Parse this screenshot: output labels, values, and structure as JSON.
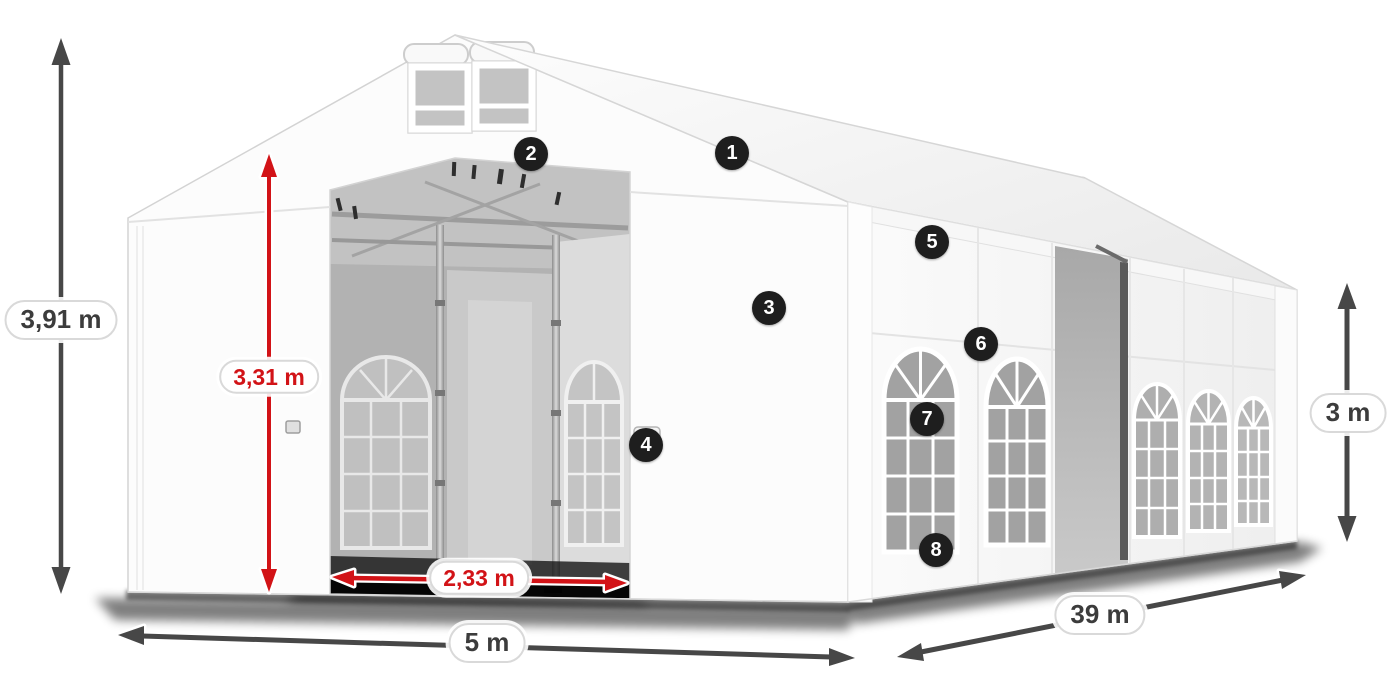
{
  "page": {
    "background_color": "#ffffff"
  },
  "product_diagram": {
    "subject": "white marquee party tent 3d render with dimension annotations",
    "colors": {
      "arrow_dark": "#474747",
      "arrow_red": "#d21317",
      "label_text_dark": "#3c3c3c",
      "label_text_red": "#d21317",
      "label_background": "#ffffff",
      "label_border": "#d9d9d9",
      "badge_background": "#1e1e1e",
      "badge_text": "#ffffff",
      "tent_white": "#fbfbfb",
      "interior_gray": "#b2b2b2"
    },
    "dimension_labels": [
      {
        "id": "total-height",
        "text": "3,91 m",
        "style": "dark"
      },
      {
        "id": "inner-height",
        "text": "3,31 m",
        "style": "red"
      },
      {
        "id": "entrance-width",
        "text": "2,33 m",
        "style": "red"
      },
      {
        "id": "tent-width",
        "text": "5 m",
        "style": "dark"
      },
      {
        "id": "tent-length",
        "text": "39 m",
        "style": "dark"
      },
      {
        "id": "side-height",
        "text": "3 m",
        "style": "dark"
      }
    ],
    "callout_badges": [
      {
        "number": "1"
      },
      {
        "number": "2"
      },
      {
        "number": "3"
      },
      {
        "number": "4"
      },
      {
        "number": "5"
      },
      {
        "number": "6"
      },
      {
        "number": "7"
      },
      {
        "number": "8"
      }
    ]
  }
}
